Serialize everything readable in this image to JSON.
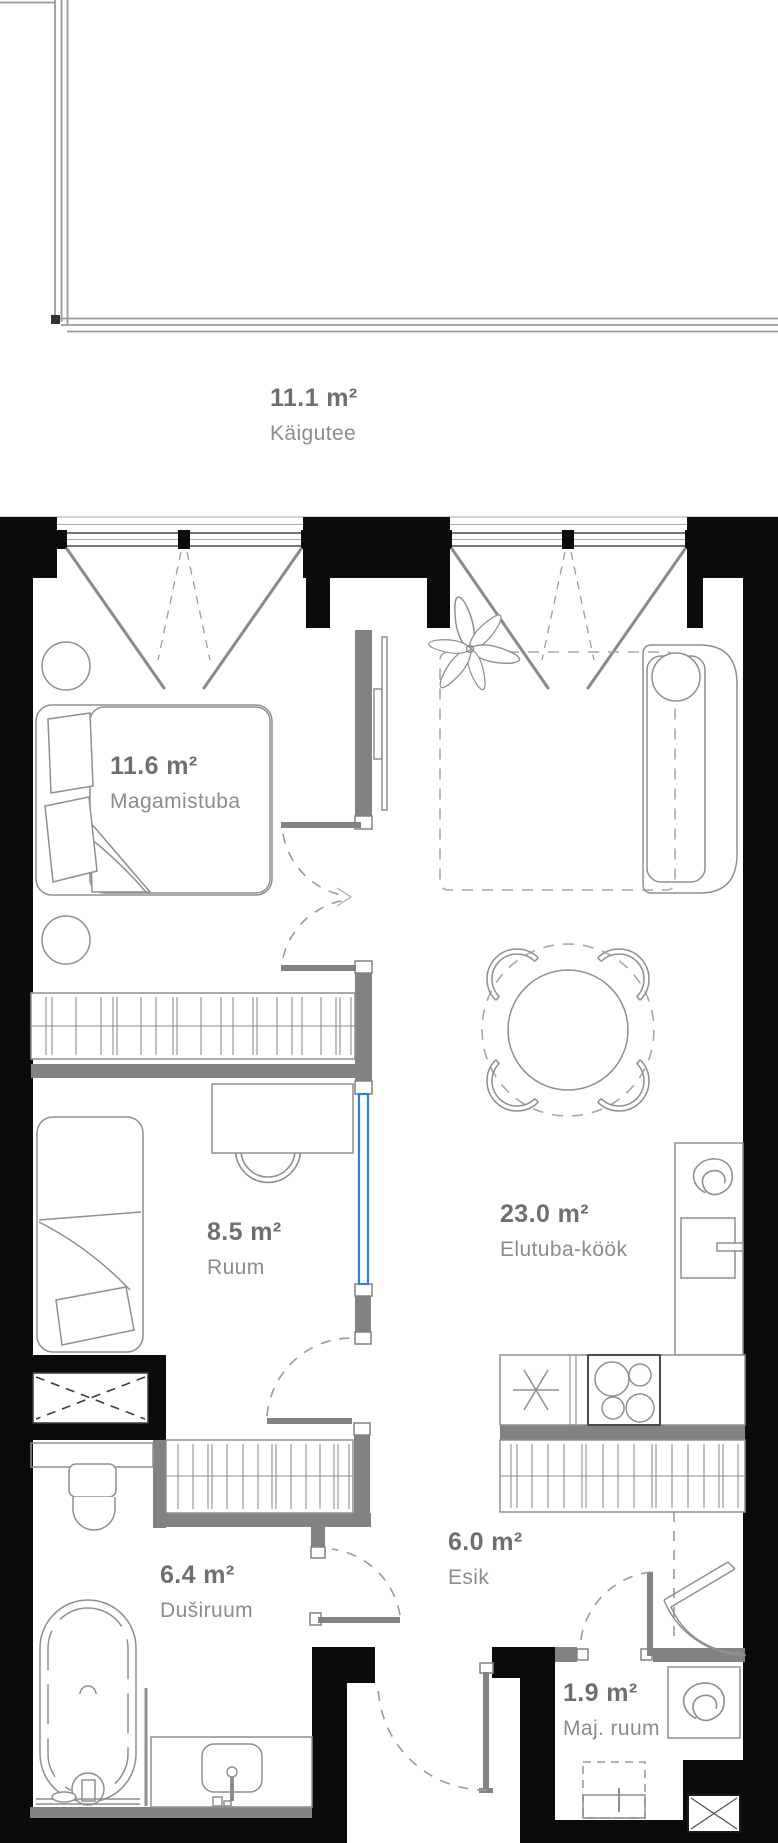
{
  "colors": {
    "wall": "#0b0b0b",
    "partition": "#828282",
    "accent": "#2f80ed",
    "line": "#8f8f8f",
    "dash": "#9b9b9b",
    "area_text": "#6f6f6f",
    "name_text": "#8c8c8c"
  },
  "rooms": [
    {
      "id": "kaigutee",
      "area": "11.1 m²",
      "name": "Käigutee"
    },
    {
      "id": "magamistuba",
      "area": "11.6 m²",
      "name": "Magamistuba"
    },
    {
      "id": "elutuba-kook",
      "area": "23.0 m²",
      "name": "Elutuba-köök"
    },
    {
      "id": "ruum",
      "area": "8.5 m²",
      "name": "Ruum"
    },
    {
      "id": "esik",
      "area": "6.0 m²",
      "name": "Esik"
    },
    {
      "id": "dusiruum",
      "area": "6.4 m²",
      "name": "Duširuum"
    },
    {
      "id": "maj-ruum",
      "area": "1.9 m²",
      "name": "Maj. ruum"
    }
  ]
}
